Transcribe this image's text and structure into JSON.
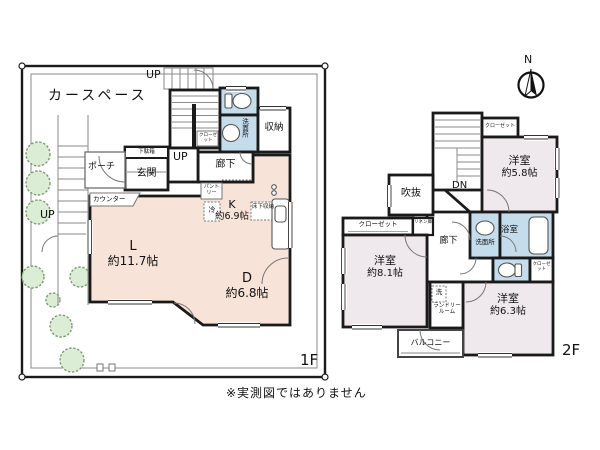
{
  "colors": {
    "wall": "#1a1a1a",
    "thin": "#8a8a8a",
    "floor1": "#f7e3d8",
    "floor2": "#efe8ed",
    "wet": "#c4dcec",
    "tree_fill": "#dcedd5",
    "tree_line": "#7c9b74",
    "paper": "#ffffff",
    "ink": "#111111"
  },
  "note": "※実測図ではありません",
  "compass": {
    "north": "N"
  },
  "floor1": {
    "label": "1F",
    "car_space": "カースペース",
    "up_top": "UP",
    "up_inner": "UP",
    "up_left": "UP",
    "porch": "ポーチ",
    "entrance": "玄関",
    "shoe_cabinet": "下駄箱",
    "counter": "カウンター",
    "living_name": "L",
    "living_size": "約11.7帖",
    "dining_name": "D",
    "dining_size": "約6.8帖",
    "kitchen_name": "K",
    "kitchen_size": "約6.9帖",
    "pantry": "パントリー",
    "fridge": "冷",
    "underfloor_storage": "床下収納",
    "corridor": "廊下",
    "washroom": "洗面所",
    "storage": "収納",
    "stair_closet": "クローゼット"
  },
  "floor2": {
    "label": "2F",
    "down": "DN",
    "void_space": "吹抜",
    "closet_a": "クローゼット",
    "room_a_name": "洋室",
    "room_a_size": "約5.8帖",
    "closet_b": "クローゼット",
    "linen": "リネン庫",
    "room_b_name": "洋室",
    "room_b_size": "約8.1帖",
    "corridor": "廊下",
    "washroom": "洗面所",
    "bathroom": "浴室",
    "closet_c": "クローゼット",
    "room_c_name": "洋室",
    "room_c_size": "約6.3帖",
    "washer": "洗",
    "laundry_room": "ランドリールーム",
    "balcony": "バルコニー"
  }
}
